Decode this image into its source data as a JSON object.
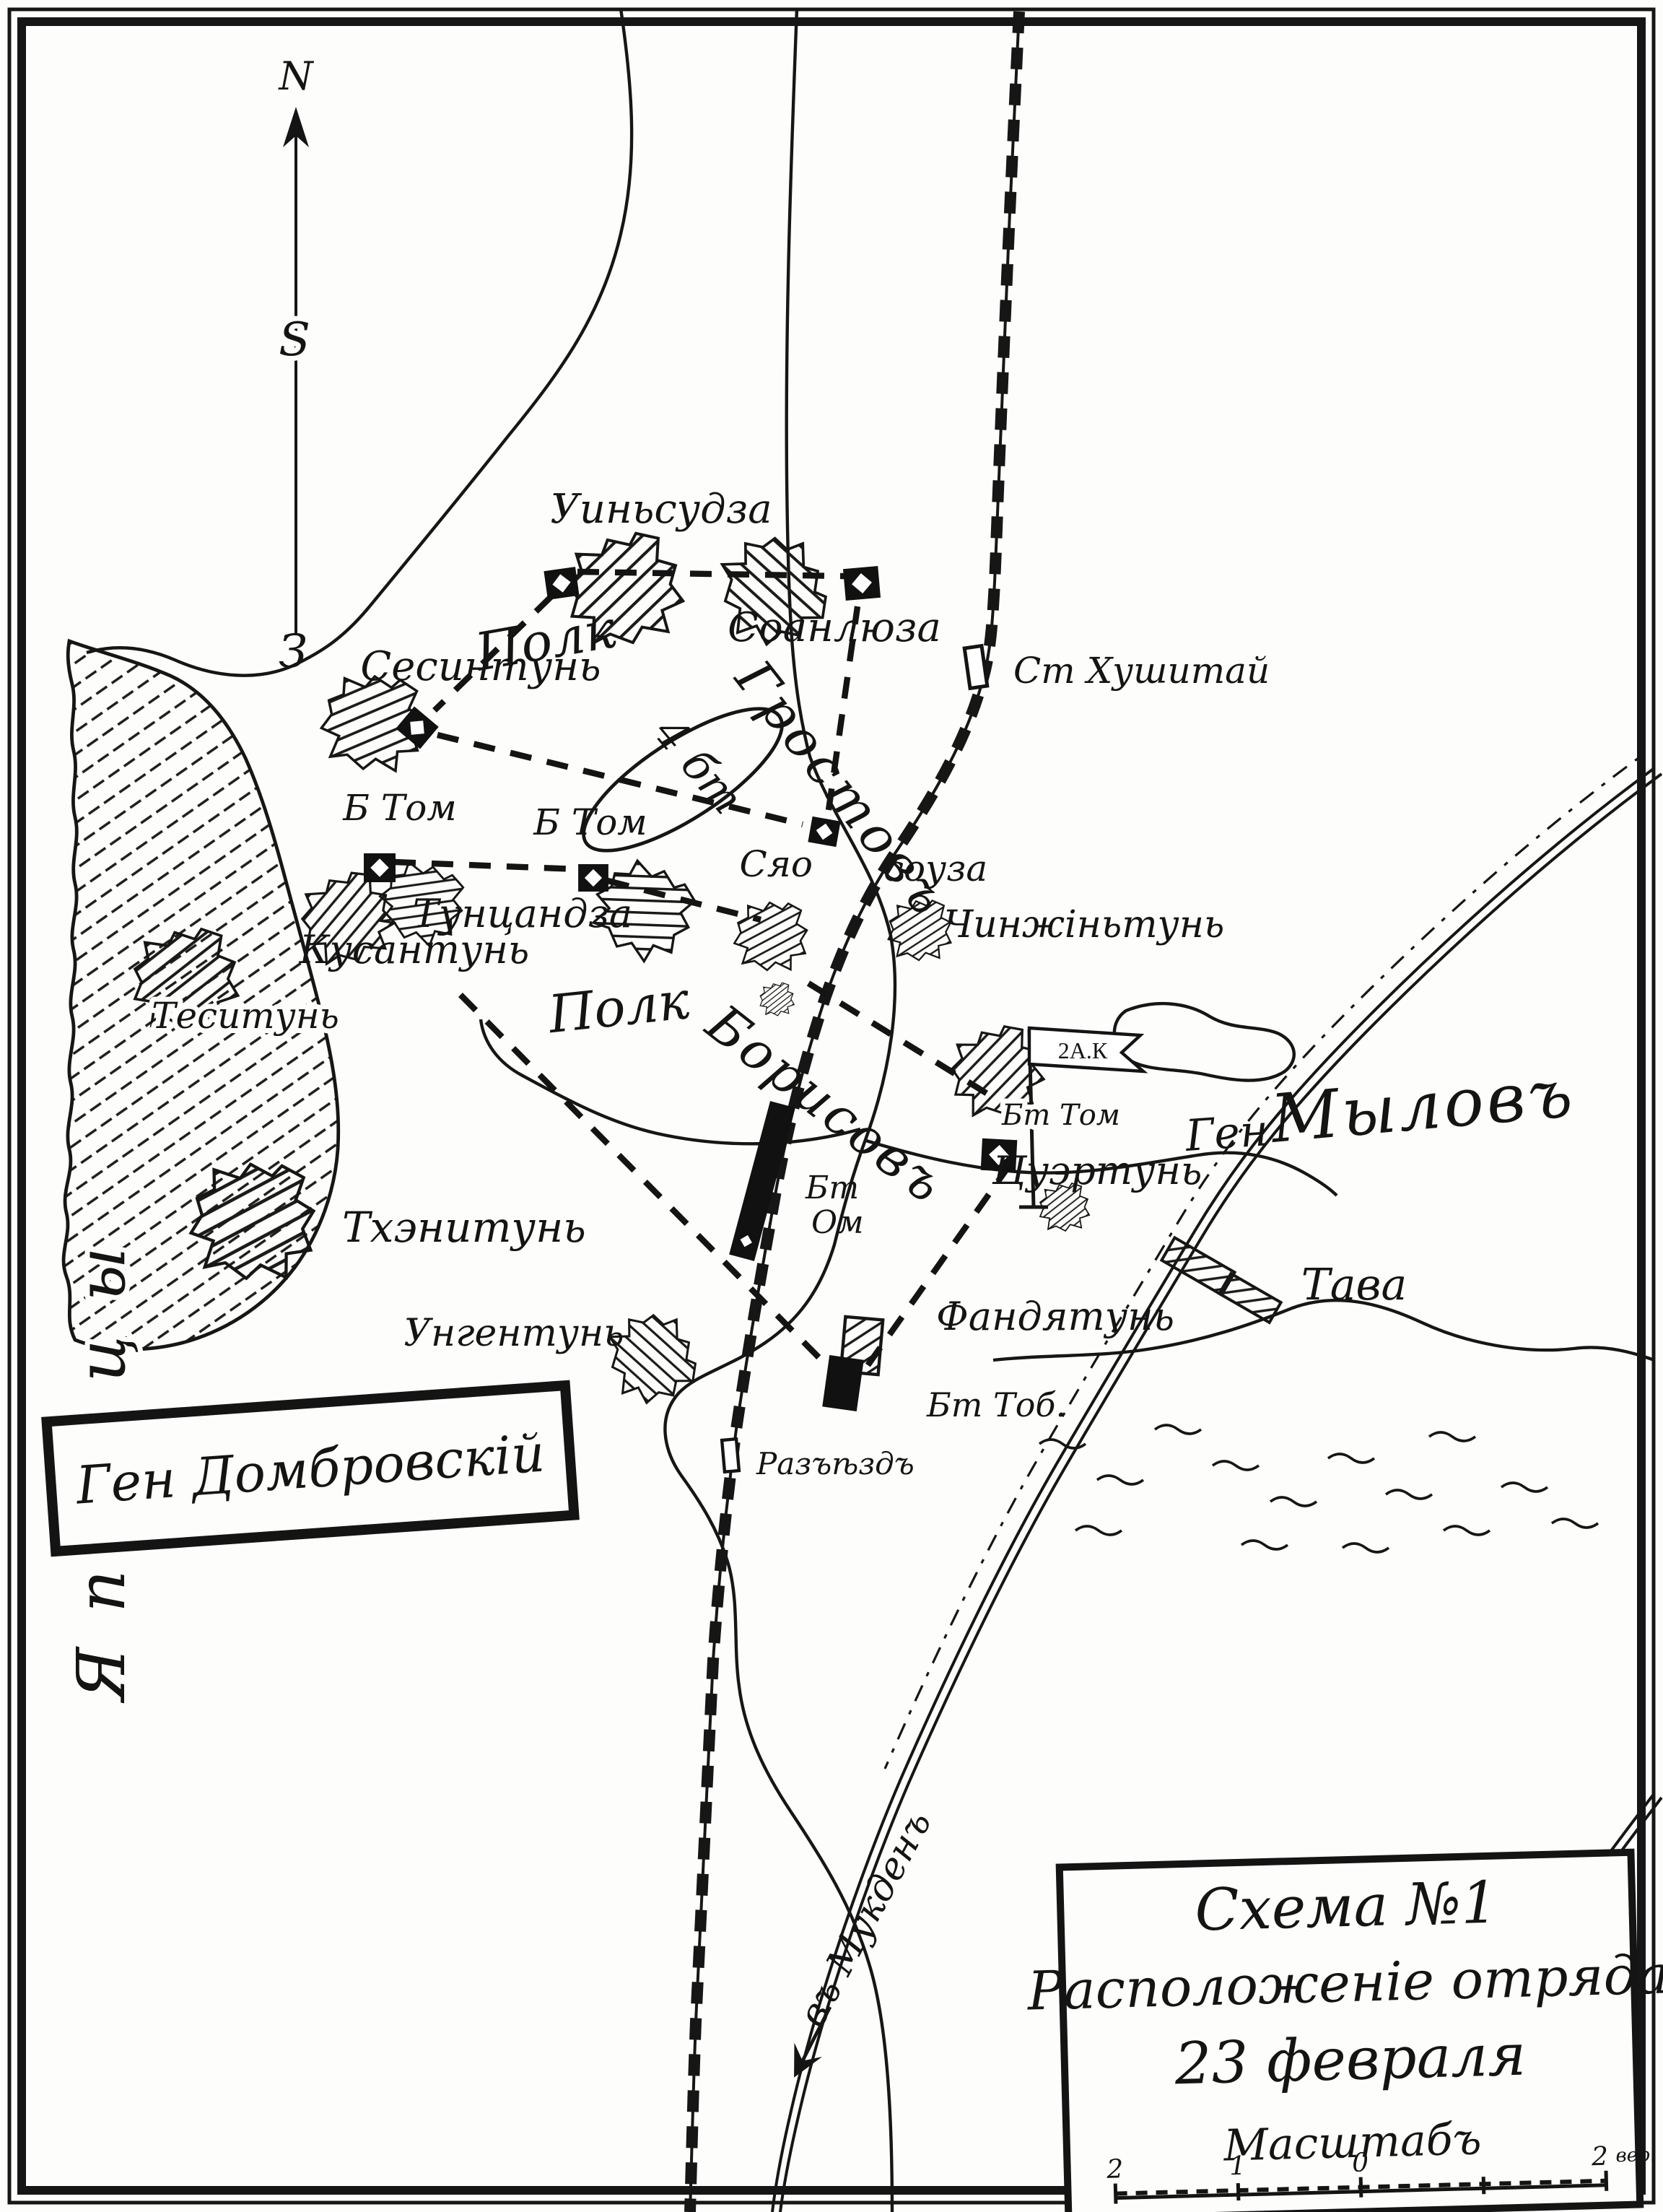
{
  "title_box": {
    "line1": "Схема №1",
    "line2": "Расположеніе отряда",
    "line3": "23 февраля",
    "line4": "Масштабъ"
  },
  "scale_bar": {
    "t0": "2",
    "t1": "1",
    "t2": "0",
    "t3": "2",
    "unit": "вер."
  },
  "compass": {
    "north": "N",
    "middle": "S",
    "south": "З"
  },
  "commanders": {
    "dombrovsky": "Ген Домбровскій",
    "gen_prefix": "Ген",
    "mylov": "Мыловъ",
    "corps_flag": "2А.К"
  },
  "regiments": {
    "north_prefix": "Полк",
    "north_name": "Гростовъ",
    "north_battalions": "4 бт",
    "center_prefix": "Полк",
    "center_name": "Борисовъ"
  },
  "battalions": {
    "b_tom_west": "Б Том",
    "b_tom_east": "Б Том",
    "bt_tom": "Бт Том",
    "bt_om_line1": "Бт",
    "bt_om_line2": "Ом",
    "bt_tob": "Бт Тоб."
  },
  "places": {
    "uinsudza": "Уиньсудза",
    "soanlyuza": "Соанлюза",
    "st_khushitai": "Ст Хушитай",
    "sesintun": "Сесинтунь",
    "tuntsandza": "Тунцандза",
    "kusantun": "Кусантунь",
    "syao": "Сяо",
    "souza": "соуза",
    "chinzhintun": "Чинжіньтунь",
    "tsuertun": "Цуэртунь",
    "tesitun": "Теситунь",
    "tkhenitun": "Тхэнитунь",
    "ungentun": "Унгентунь",
    "fandyatun": "Фандятунь",
    "tava": "Тава",
    "razezd": "Разъѣздъ",
    "v_mukden": "въ Мукденъ",
    "japanese_zone": "Японцы"
  }
}
